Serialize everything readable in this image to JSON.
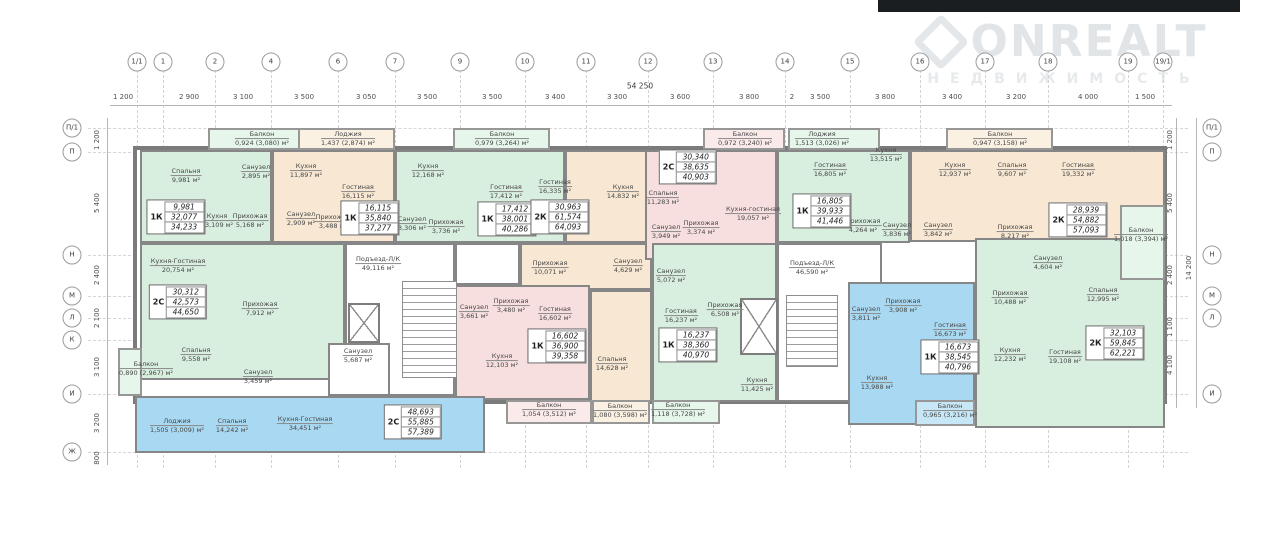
{
  "watermark": {
    "brand": "ONREALT",
    "subtext": "НЕДВИЖИМОСТЬ"
  },
  "plan": {
    "total_width_label": "54 250",
    "total_height_label": "14 200"
  },
  "axes_top": {
    "labels": [
      "1/1",
      "1",
      "2",
      "4",
      "6",
      "7",
      "9",
      "10",
      "11",
      "12",
      "13",
      "14",
      "15",
      "16",
      "17",
      "18",
      "19",
      "19/1"
    ],
    "dims": [
      "1 200",
      "2 900",
      "3 100",
      "3 500",
      "3 050",
      "3 500",
      "3 500",
      "3 400",
      "3 300",
      "3 600",
      "3 800",
      "2",
      "3 500",
      "3 800",
      "3 400",
      "3 200",
      "4 000",
      "1 500"
    ]
  },
  "axes_left": {
    "labels": [
      "П/1",
      "П",
      "Н",
      "М",
      "Л",
      "К",
      "И",
      "Ж"
    ],
    "dims": [
      "1 200",
      "5 400",
      "2 400",
      "2 100",
      "3 100",
      "3 200",
      "800"
    ]
  },
  "axes_right": {
    "labels": [
      "П/1",
      "П",
      "Н",
      "М",
      "Л",
      "И"
    ],
    "dims": [
      "1 200",
      "5 400",
      "2 400",
      "1 100",
      "4 100"
    ]
  },
  "common_areas": [
    {
      "name": "Подъезд-Л/К",
      "area": "49,116 м²"
    },
    {
      "name": "Подъезд-Л/К",
      "area": "46,590 м²"
    }
  ],
  "apartments": [
    {
      "type": "1К",
      "stats": [
        "9,981",
        "32,077",
        "34,233"
      ],
      "rooms": [
        {
          "name": "Балкон",
          "area": "0,924 (3,080) м²"
        },
        {
          "name": "Спальня",
          "area": "9,981 м²"
        },
        {
          "name": "Санузел",
          "area": "2,895 м²"
        },
        {
          "name": "Кухня",
          "area": "13,109 м²"
        },
        {
          "name": "Прихожая",
          "area": "5,168 м²"
        }
      ]
    },
    {
      "type": "1К",
      "stats": [
        "16,115",
        "35,840",
        "37,277"
      ],
      "rooms": [
        {
          "name": "Лоджия",
          "area": "1,437 (2,874) м²"
        },
        {
          "name": "Кухня",
          "area": "11,897 м²"
        },
        {
          "name": "Гостиная",
          "area": "16,115 м²"
        },
        {
          "name": "Санузел",
          "area": "2,909 м²"
        },
        {
          "name": "Прихожая",
          "area": "3,488 м²"
        }
      ]
    },
    {
      "type": "1К",
      "stats": [
        "17,412",
        "38,001",
        "40,286"
      ],
      "rooms": [
        {
          "name": "Балкон",
          "area": "0,979 (3,264) м²"
        },
        {
          "name": "Кухня",
          "area": "12,168 м²"
        },
        {
          "name": "Гостиная",
          "area": "17,412 м²"
        },
        {
          "name": "Санузел",
          "area": "3,306 м²"
        },
        {
          "name": "Прихожая",
          "area": "3,736 м²"
        }
      ]
    },
    {
      "type": "2К",
      "stats": [
        "30,963",
        "61,574",
        "64,093"
      ],
      "rooms": [
        {
          "name": "Гостиная",
          "area": "16,335 м²"
        },
        {
          "name": "Кухня",
          "area": "14,832 м²"
        },
        {
          "name": "Прихожая",
          "area": "10,071 м²"
        },
        {
          "name": "Санузел",
          "area": "4,629 м²"
        },
        {
          "name": "Спальня",
          "area": "14,628 м²"
        },
        {
          "name": "Балкон",
          "area": "1,080 (3,598) м²"
        }
      ]
    },
    {
      "type": "2С",
      "stats": [
        "30,340",
        "38,635",
        "40,903"
      ],
      "rooms": [
        {
          "name": "Балкон",
          "area": "0,972 (3,240) м²"
        },
        {
          "name": "Спальня",
          "area": "11,283 м²"
        },
        {
          "name": "Санузел",
          "area": "3,949 м²"
        },
        {
          "name": "Прихожая",
          "area": "3,374 м²"
        },
        {
          "name": "Кухня-гостиная",
          "area": "19,057 м²"
        }
      ]
    },
    {
      "type": "1К",
      "stats": [
        "16,805",
        "39,933",
        "41,446"
      ],
      "rooms": [
        {
          "name": "Лоджия",
          "area": "1,513 (3,026) м²"
        },
        {
          "name": "Гостиная",
          "area": "16,805 м²"
        },
        {
          "name": "Кухня",
          "area": "13,515 м²"
        },
        {
          "name": "Прихожая",
          "area": "4,264 м²"
        },
        {
          "name": "Санузел",
          "area": "3,836 м²"
        }
      ]
    },
    {
      "type": "2К",
      "stats": [
        "28,939",
        "54,882",
        "57,093"
      ],
      "rooms": [
        {
          "name": "Балкон",
          "area": "0,947 (3,158) м²"
        },
        {
          "name": "Кухня",
          "area": "12,937 м²"
        },
        {
          "name": "Спальня",
          "area": "9,607 м²"
        },
        {
          "name": "Гостиная",
          "area": "19,332 м²"
        },
        {
          "name": "Прихожая",
          "area": "8,217 м²"
        },
        {
          "name": "Санузел",
          "area": "3,842 м²"
        }
      ]
    },
    {
      "type": "2С",
      "stats": [
        "30,312",
        "42,573",
        "44,650"
      ],
      "rooms": [
        {
          "name": "Кухня-Гостиная",
          "area": "20,754 м²"
        },
        {
          "name": "Прихожая",
          "area": "7,912 м²"
        },
        {
          "name": "Спальня",
          "area": "9,558 м²"
        },
        {
          "name": "Санузел",
          "area": "3,459 м²"
        },
        {
          "name": "Балкон",
          "area": "0,890 (2,967) м²"
        }
      ]
    },
    {
      "type": "1К",
      "stats": [
        "16,602",
        "36,900",
        "39,358"
      ],
      "rooms": [
        {
          "name": "Санузел",
          "area": "3,661 м²"
        },
        {
          "name": "Прихожая",
          "area": "3,480 м²"
        },
        {
          "name": "Гостиная",
          "area": "16,602 м²"
        },
        {
          "name": "Кухня",
          "area": "12,103 м²"
        },
        {
          "name": "Балкон",
          "area": "1,054 (3,512) м²"
        }
      ]
    },
    {
      "type": "1К",
      "stats": [
        "16,237",
        "38,360",
        "40,970"
      ],
      "rooms": [
        {
          "name": "Санузел",
          "area": "5,072 м²"
        },
        {
          "name": "Гостиная",
          "area": "16,237 м²"
        },
        {
          "name": "Прихожая",
          "area": "6,508 м²"
        },
        {
          "name": "Кухня",
          "area": "11,425 м²"
        },
        {
          "name": "Балкон",
          "area": "1,118 (3,728) м²"
        }
      ]
    },
    {
      "type": "1К",
      "stats": [
        "16,673",
        "38,545",
        "40,796"
      ],
      "rooms": [
        {
          "name": "Санузел",
          "area": "3,811 м²"
        },
        {
          "name": "Прихожая",
          "area": "3,908 м²"
        },
        {
          "name": "Гостиная",
          "area": "16,673 м²"
        },
        {
          "name": "Кухня",
          "area": "13,988 м²"
        },
        {
          "name": "Балкон",
          "area": "0,965 (3,216) м²"
        }
      ]
    },
    {
      "type": "2К",
      "stats": [
        "32,103",
        "59,845",
        "62,221"
      ],
      "rooms": [
        {
          "name": "Санузел",
          "area": "4,604 м²"
        },
        {
          "name": "Прихожая",
          "area": "10,488 м²"
        },
        {
          "name": "Спальня",
          "area": "12,995 м²"
        },
        {
          "name": "Кухня",
          "area": "12,232 м²"
        },
        {
          "name": "Гостиная",
          "area": "19,108 м²"
        },
        {
          "name": "Балкон",
          "area": "1,018 (3,394) м²"
        }
      ]
    },
    {
      "type": "2С",
      "stats": [
        "48,693",
        "55,885",
        "57,389"
      ],
      "rooms": [
        {
          "name": "Лоджия",
          "area": "1,505 (3,009) м²"
        },
        {
          "name": "Спальня",
          "area": "14,242 м²"
        },
        {
          "name": "Кухня-Гостиная",
          "area": "34,451 м²"
        },
        {
          "name": "Санузел",
          "area": "5,687 м²"
        }
      ]
    }
  ]
}
